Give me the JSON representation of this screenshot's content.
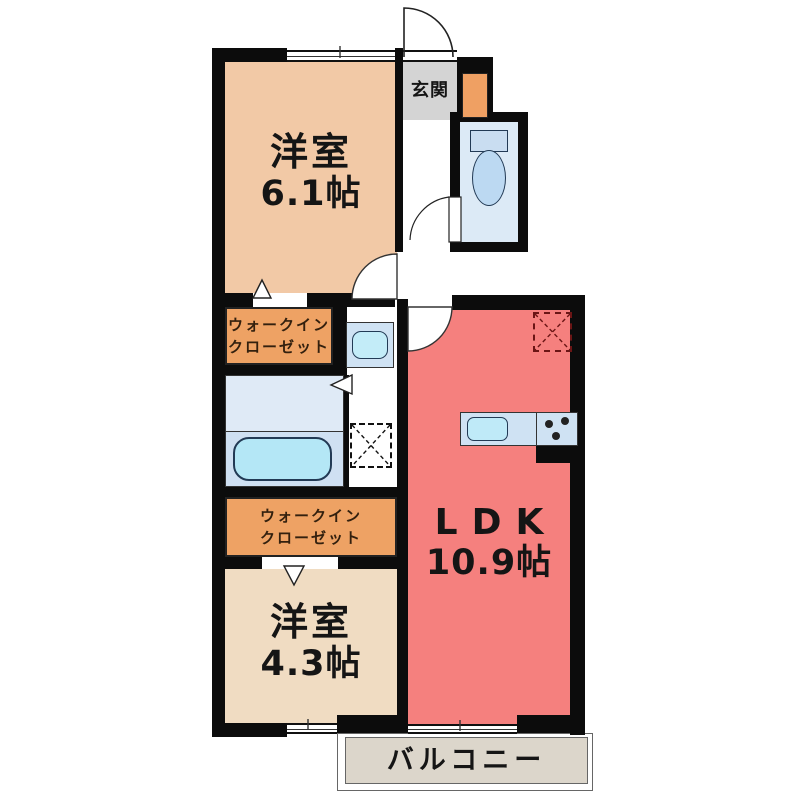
{
  "plan": {
    "title": "apartment-floor-plan",
    "entrance": {
      "label": "玄関"
    },
    "bedroom1": {
      "name": "洋室",
      "size": "6.1帖"
    },
    "bedroom2": {
      "name": "洋室",
      "size": "4.3帖"
    },
    "ldk": {
      "name": "LDK",
      "size": "10.9帖"
    },
    "walk_in_closet": {
      "line1": "ウォークイン",
      "line2": "クローゼット"
    },
    "balcony": {
      "label": "バルコニー"
    },
    "fixtures": [
      "entrance-door-arc",
      "toilet-icon",
      "toilet-door-arc",
      "bedroom1-door-arc",
      "ldk-door-arc",
      "closet-door-marker",
      "bath-folding-door-marker",
      "washbasin-icon",
      "bathtub-icon",
      "washing-machine-space-icon",
      "refrigerator-space-icon",
      "kitchen-counter",
      "sink-icon",
      "stove-burners-icon",
      "window",
      "sliding-window"
    ]
  },
  "colors": {
    "wall": "#0c0c0c",
    "bedroom1_fill": "#f2c9a6",
    "bedroom2_fill": "#f0dcc2",
    "closet_fill": "#eea264",
    "ldk_fill": "#f5807e",
    "entrance_fill": "#d4d4d4",
    "toilet_room_fill": "#dceaf6",
    "bath_fill": "#cfe0f2",
    "fixture_blue": "#c3ecf8",
    "balcony_fill": "#dcd6cb"
  }
}
